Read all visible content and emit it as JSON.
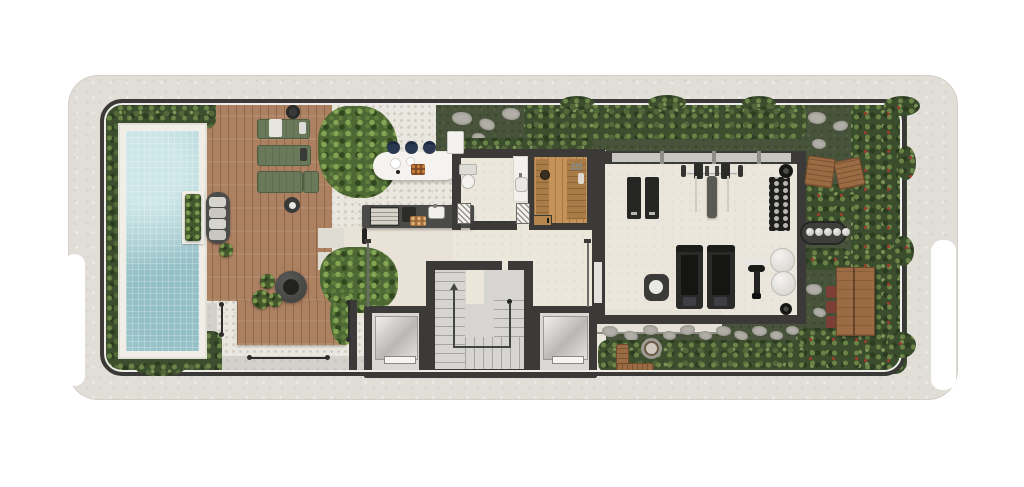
{
  "scene": {
    "type": "residential floor plan, top-down 3D architectural render",
    "level": "amenities / rooftop level",
    "text_labels": [],
    "zones": [
      {
        "name": "pool-garden",
        "items": [
          "mosaic swimming pool",
          "stone pool coping",
          "in-pool planter box",
          "perimeter hedge"
        ]
      },
      {
        "name": "sun-deck",
        "items": [
          "cushioned daybed",
          "green sun lounger x3",
          "round side table x2",
          "round fire table",
          "potted plant x4"
        ]
      },
      {
        "name": "outdoor-bar",
        "items": [
          "oval white bar island",
          "navy bar stool x3",
          "serving tray",
          "plates"
        ]
      },
      {
        "name": "outdoor-kitchen",
        "items": [
          "grill counter",
          "grill grate",
          "hob",
          "cutting board with bread",
          "sink with faucet",
          "hanging tools"
        ]
      },
      {
        "name": "bathroom",
        "items": [
          "toilet",
          "vanity counter with basin",
          "hatched swing door x2"
        ]
      },
      {
        "name": "sauna",
        "items": [
          "timber wall benches x2",
          "bucket",
          "timber door"
        ]
      },
      {
        "name": "circulation-core",
        "items": [
          "u-shaped staircase with walk line arrow",
          "elevator x2",
          "leader line x2"
        ]
      },
      {
        "name": "gym",
        "items": [
          "exercise mat x2",
          "barbell bench station",
          "vertical dumbbell rack",
          "treadmill x2",
          "spin bike with mat",
          "white pouf x2",
          "dark pouf with towel",
          "ceiling speaker x2",
          "glazed front wall",
          "entry door panel"
        ]
      },
      {
        "name": "east-garden",
        "items": [
          "timber armchair x2",
          "barbecue grill with skewers",
          "timber dining table",
          "red chair x3",
          "stone pavers",
          "berry shrubs"
        ]
      },
      {
        "name": "south-garden",
        "items": [
          "l-shaped timber bench",
          "stone fire pit",
          "stone paver path",
          "shrub border"
        ]
      },
      {
        "name": "site",
        "items": [
          "textured roof slab",
          "rounded parapet wall",
          "white side notch x2",
          "gravel terrace",
          "grey walkway",
          "dimension line x3"
        ]
      }
    ],
    "annotations": {
      "dimension_lines": 3,
      "numeric_labels_visible": false
    }
  },
  "palette": {
    "background": "#ffffff",
    "slab": "#e1ded8",
    "parapet_wall": "#3b3a38",
    "pool_water": "#a9cfd3",
    "pool_coping": "#f0eee7",
    "deck_wood": "#ac8161",
    "gravel": "#eae7e0",
    "interior_floor": "#ece7db",
    "walkway": "#d3d1cb",
    "grass": "#47533a",
    "foliage": "#3c4e2d",
    "sauna_wood": "#c59259",
    "lounger_green": "#6a795a",
    "stool_navy": "#2a3950",
    "equipment_black": "#262624",
    "outdoor_wood": "#9b6b44",
    "chair_red": "#7c3e35"
  }
}
